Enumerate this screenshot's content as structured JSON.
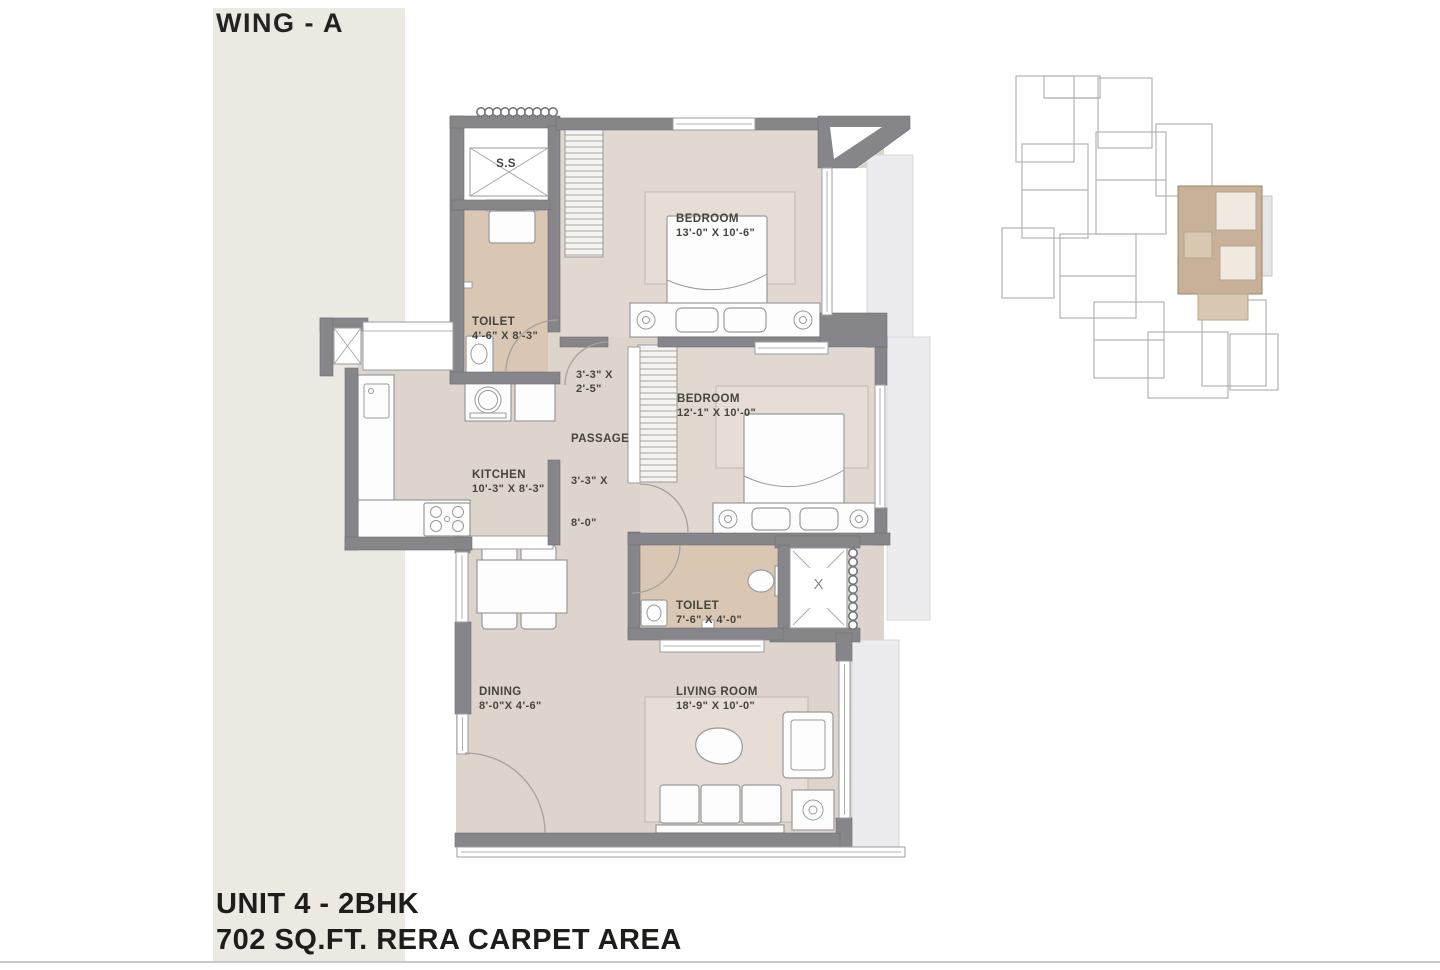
{
  "header": {
    "wing": "WING - A"
  },
  "footer": {
    "unit": "UNIT 4 - 2BHK",
    "area": "702 SQ.FT. RERA CARPET AREA"
  },
  "plan": {
    "ss": "S.S",
    "shaft_mark": "X",
    "toilet1": {
      "name": "TOILET",
      "dim": "4'-6\" X 8'-3\""
    },
    "bedroom1": {
      "name": "BEDROOM",
      "dim": "13'-0\" X 10'-6\""
    },
    "nook": {
      "dim1": "3'-3\" X",
      "dim2": "2'-5\""
    },
    "passage": {
      "name": "PASSAGE",
      "dim1": "3'-3\" X",
      "dim2": "8'-0\""
    },
    "kitchen": {
      "name": "KITCHEN",
      "dim": "10'-3\" X 8'-3\""
    },
    "bedroom2": {
      "name": "BEDROOM",
      "dim": "12'-1\" X 10'-0\""
    },
    "toilet2": {
      "name": "TOILET",
      "dim": "7'-6\" X 4'-0\""
    },
    "dining": {
      "name": "DINING",
      "dim": "8'-0\"X 4'-6\""
    },
    "living": {
      "name": "LIVING ROOM",
      "dim": "18'-9\" X 10'-0\""
    }
  },
  "colors": {
    "stripe": "#ece8e2",
    "wall": "#85858a",
    "floor": "#ddd4cc",
    "floor_bedroom": "#e1d8d0",
    "floor_toilet": "#d9c7b4",
    "deck": "#ececee",
    "rug": "#e6ded6",
    "highlight_unit": "#c9b199",
    "text": "#45453f"
  }
}
